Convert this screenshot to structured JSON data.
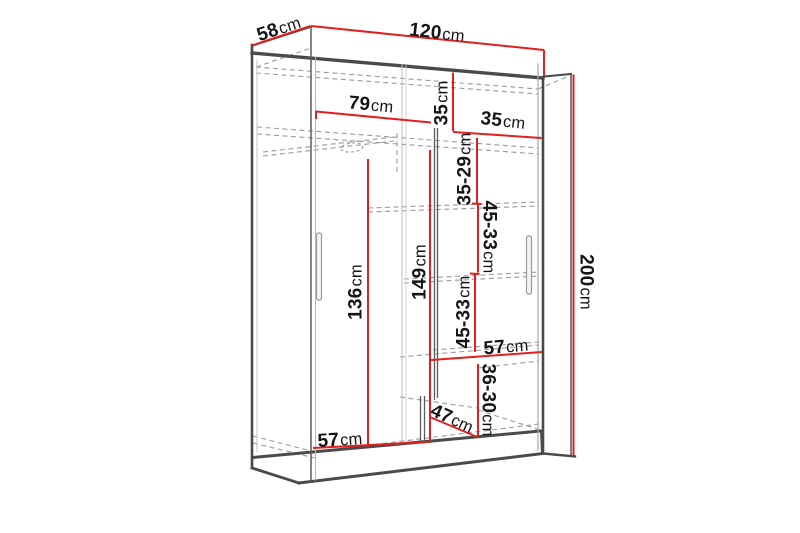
{
  "diagram": {
    "subject": "sliding-door wardrobe dimension drawing",
    "unit": "cm"
  },
  "dimensions": {
    "depth_top": {
      "value": "58",
      "unit": "cm"
    },
    "width_top": {
      "value": "120",
      "unit": "cm"
    },
    "height_right": {
      "value": "200",
      "unit": "cm"
    },
    "left_section_width": {
      "value": "79",
      "unit": "cm"
    },
    "top_shelf_drop": {
      "value": "35",
      "unit": "cm"
    },
    "top_right_shelf_width": {
      "value": "35",
      "unit": "cm"
    },
    "right_gap_top": {
      "value": "35-29",
      "unit": "cm"
    },
    "right_gap_middle": {
      "value": "45-33",
      "unit": "cm"
    },
    "right_gap_lower": {
      "value": "45-33",
      "unit": "cm"
    },
    "hanging_height": {
      "value": "136",
      "unit": "cm"
    },
    "left_inner_height": {
      "value": "149",
      "unit": "cm"
    },
    "bottom_left_width": {
      "value": "57",
      "unit": "cm"
    },
    "bottom_depth": {
      "value": "47",
      "unit": "cm"
    },
    "bottom_right_height": {
      "value": "36-30",
      "unit": "cm"
    },
    "bottom_right_width": {
      "value": "57",
      "unit": "cm"
    }
  },
  "colors": {
    "dimension_line": "#e01f1f",
    "structure": "#4a4a4a",
    "hidden_line": "#9a9a9a",
    "background": "#ffffff"
  }
}
